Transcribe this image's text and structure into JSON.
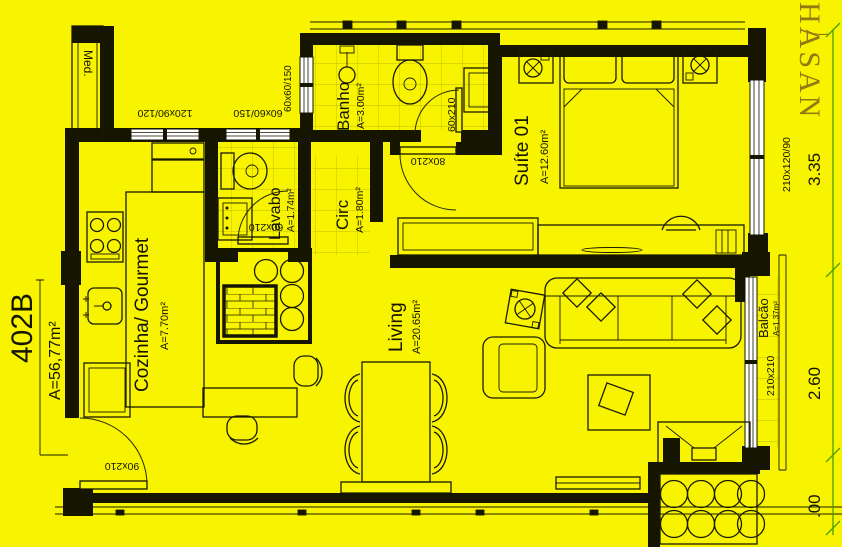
{
  "plan": {
    "unit_label": "402B",
    "unit_area": "A=56,77m²",
    "watermark": "HASAN",
    "shaft_label": "Med.",
    "rooms": {
      "cozinha": {
        "name": "Cozinha/ Gourmet",
        "area": "A=7.70m²"
      },
      "lavabo": {
        "name": "Lavabo",
        "area": "A=1.74m²"
      },
      "banho": {
        "name": "Banho",
        "area": "A=3.00m²"
      },
      "circ": {
        "name": "Circ",
        "area": "A=1.80m²"
      },
      "suite": {
        "name": "Suíte 01",
        "area": "A=12.60m²"
      },
      "living": {
        "name": "Living",
        "area": "A=20.65m²"
      },
      "balcao": {
        "name": "Balcão",
        "area": "A=1.37m²"
      }
    },
    "openings": {
      "kitchen_window": "120x90/120",
      "lavabo_window": "60x60/150",
      "banho_window": "60x60/150",
      "banho_door": "60x210",
      "lavabo_door": "60x210",
      "suite_door": "80x210",
      "entry_door": "90x210",
      "suite_window": "210x120/90",
      "balcony_window": "210x210"
    },
    "dimensions": {
      "right_top": "3.35",
      "right_middle": "2.60",
      "right_bottom": ".00"
    },
    "colors": {
      "background": "#f8f400",
      "line": "#151500",
      "dimension_line": "#4aa000",
      "watermark": "#8a6d14"
    }
  }
}
